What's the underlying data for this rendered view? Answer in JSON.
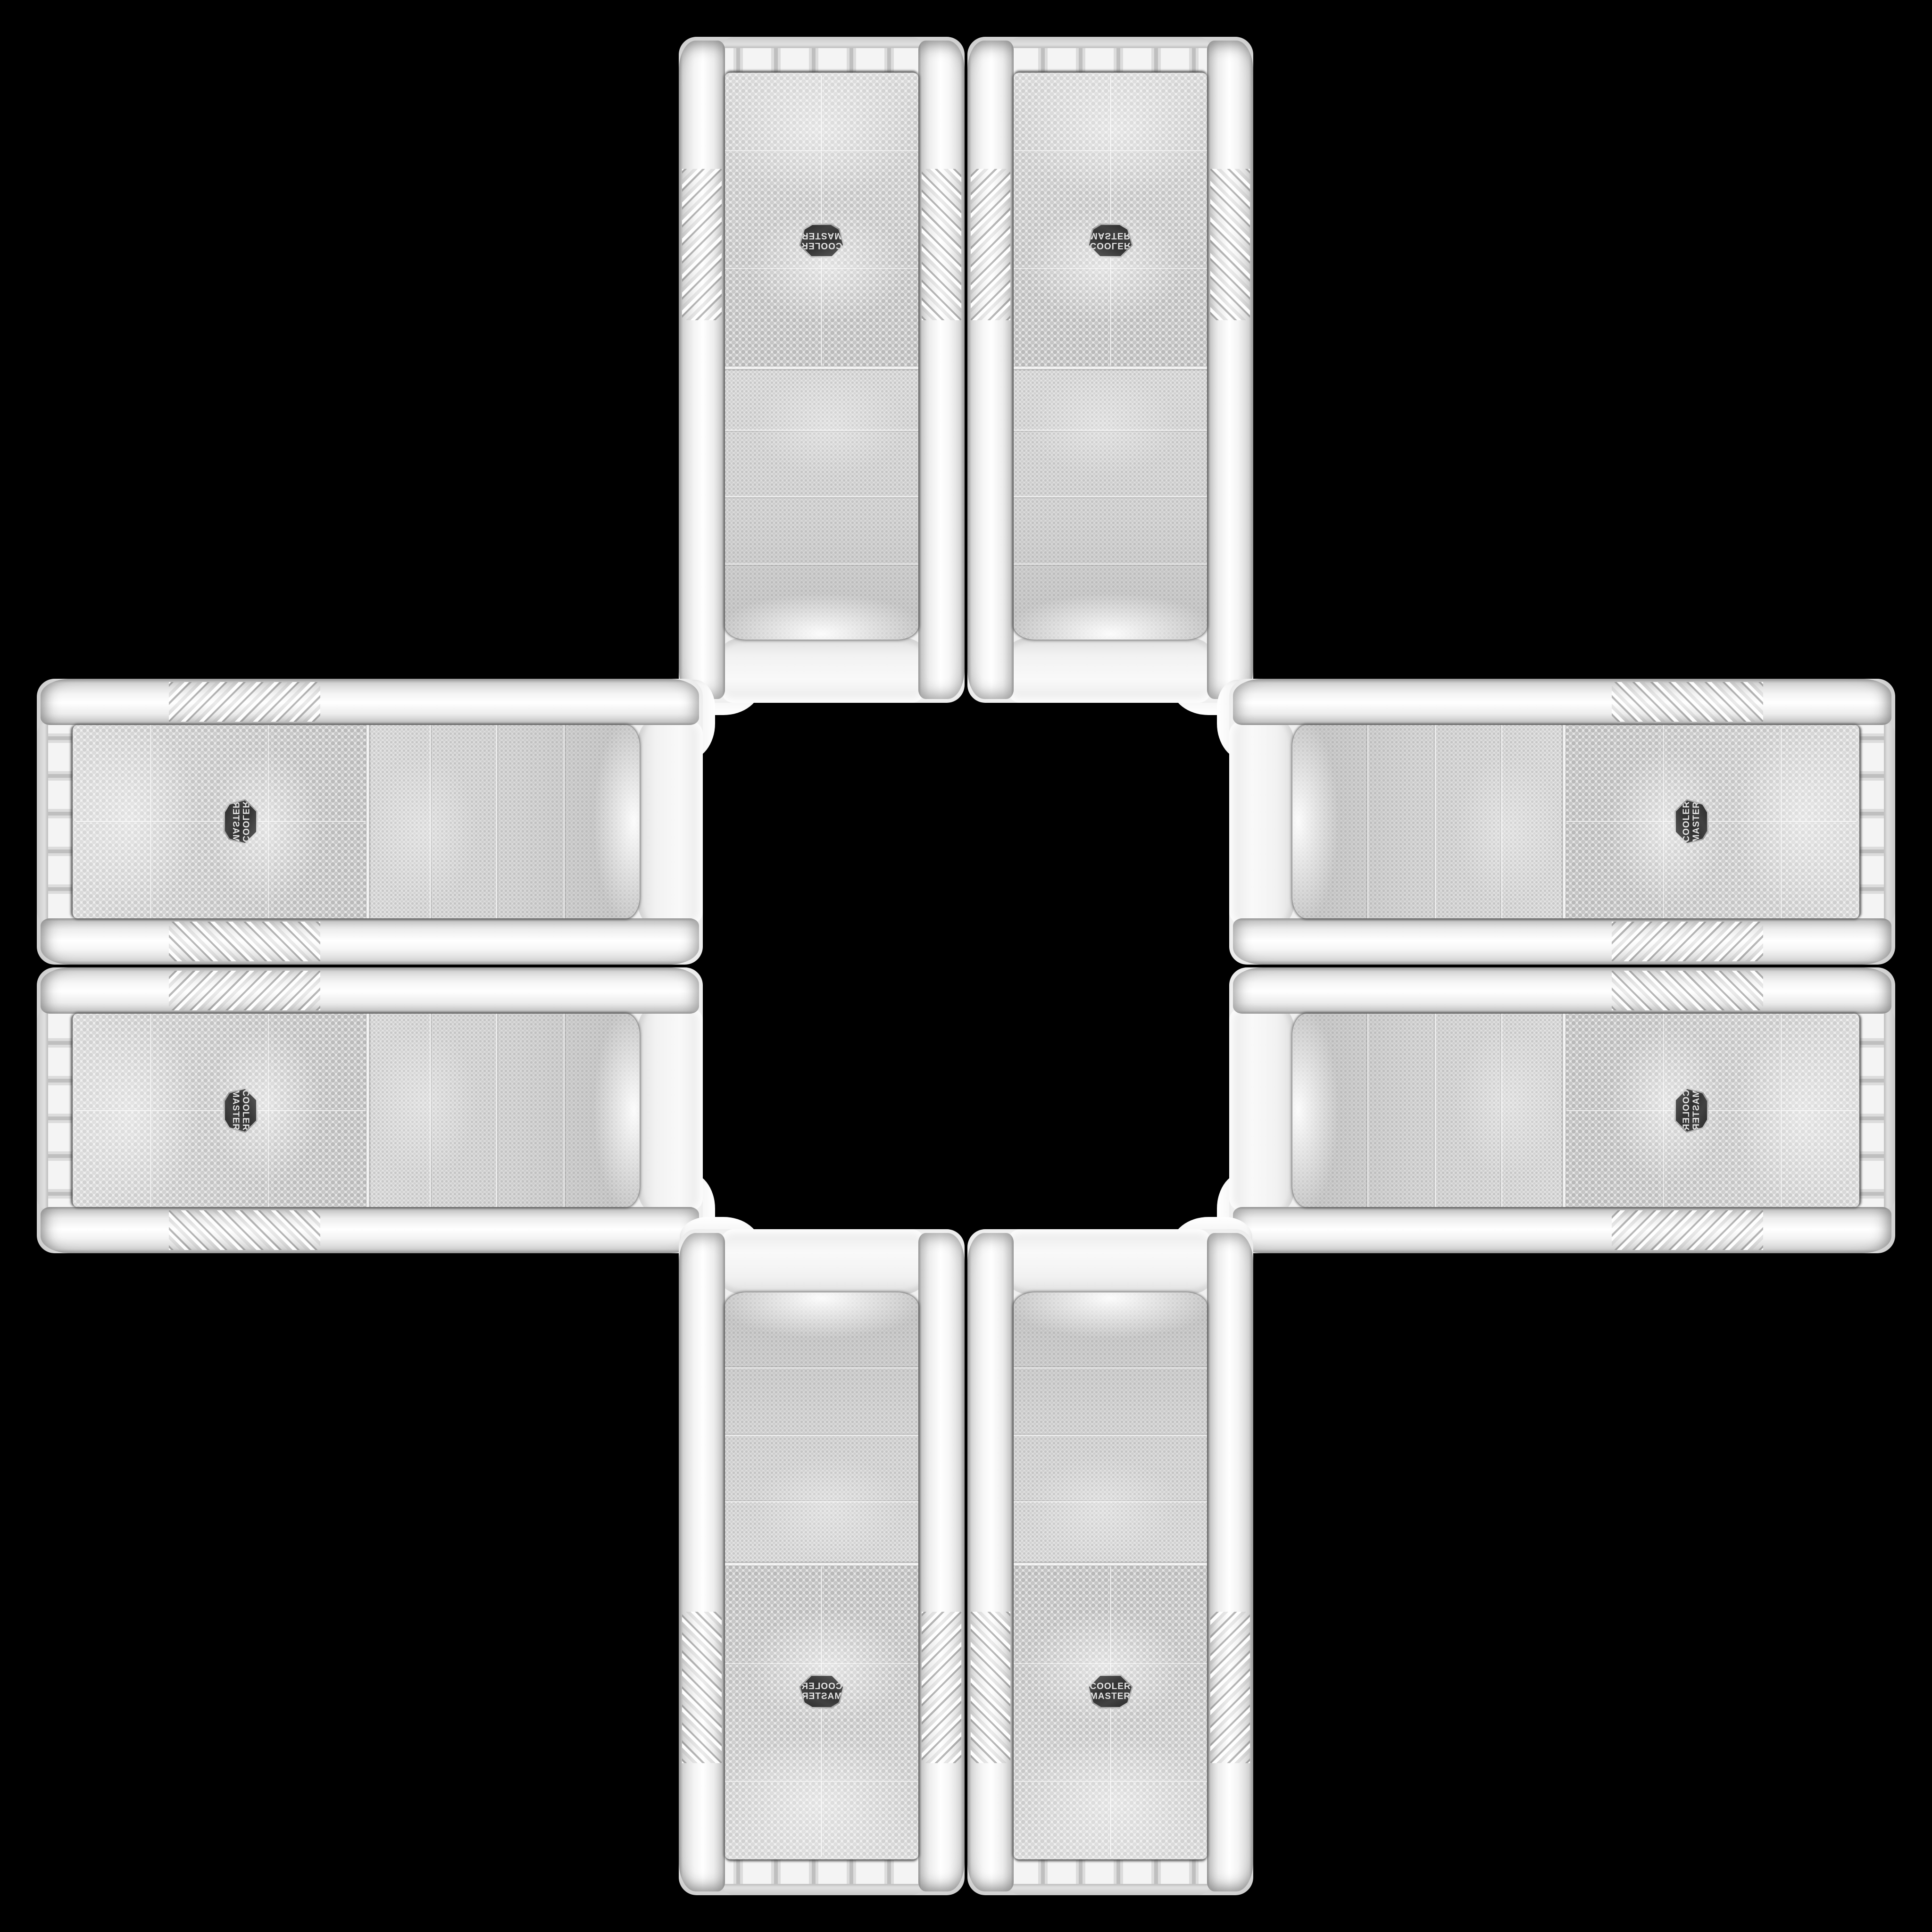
{
  "scene": {
    "background_color": "#000000",
    "description": "Eight identical white Cooler Master mesh-front PC tower cases arranged edge-to-edge in a plus / cross kaleidoscope pattern on a black background; copies are rotated and mirrored so the logos face in different orientations"
  },
  "brand": {
    "line1": "COOLER",
    "line2": "MASTER"
  },
  "badge": {
    "shape": "hexagon",
    "background": "#333333",
    "text_color": "#e4e4e4"
  },
  "colors": {
    "case_body": "#f1f1f1",
    "mesh_base": "#e4e4e4",
    "mesh_dot_fine": "#c2c2c2",
    "mesh_dot_coarse": "#b0b0b0",
    "chrome_seam": "#8c8c8c",
    "background": "#000000"
  },
  "cases": [
    {
      "slot": "top-left",
      "orientation": "rotated-180"
    },
    {
      "slot": "top-right",
      "orientation": "flipped-vertical"
    },
    {
      "slot": "left-top",
      "orientation": "rotated-90-ccw-mirrored"
    },
    {
      "slot": "left-bottom",
      "orientation": "rotated-90-cw"
    },
    {
      "slot": "right-top",
      "orientation": "rotated-90-ccw"
    },
    {
      "slot": "right-bottom",
      "orientation": "rotated-90-ccw-flipped-vertical"
    },
    {
      "slot": "bottom-left",
      "orientation": "mirrored-horizontal"
    },
    {
      "slot": "bottom-right",
      "orientation": "upright"
    }
  ]
}
